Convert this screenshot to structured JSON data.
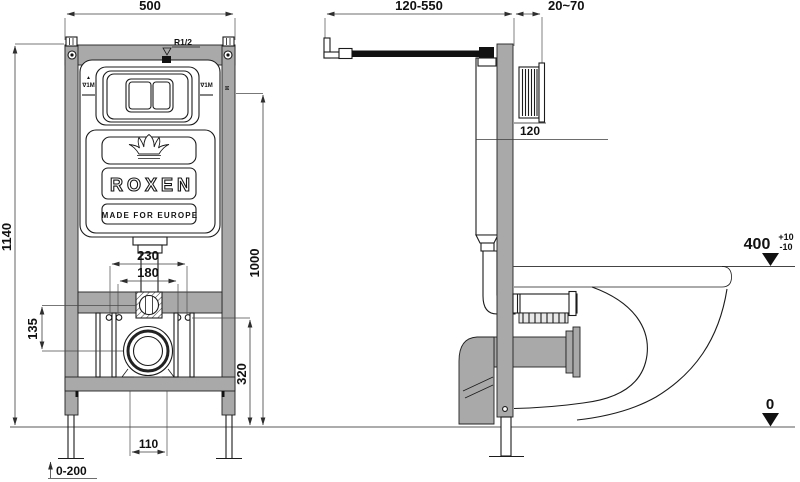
{
  "front_view": {
    "dims": {
      "width": "500",
      "height": "1140",
      "flush_center_height": "1000",
      "top_holes_span": "230",
      "inner_holes_span": "180",
      "outlet_offset": "135",
      "drain_center_height": "320",
      "outlet_width": "110",
      "leg_adjustment": "0-200"
    },
    "labels": {
      "water_inlet": "R1/2",
      "level_mark_arrow": "▲",
      "level_mark_left": "∇1M",
      "level_mark_right": "∇1M",
      "frame_mark": "M"
    },
    "brand": {
      "logo_name": "ROXEN",
      "tagline": "MADE FOR EUROPE"
    }
  },
  "side_view": {
    "dims": {
      "bracket_depth_range": "120-550",
      "wall_distance": "20~70",
      "plate_dim": "120"
    },
    "datums": {
      "rim_level": "400",
      "rim_tol_plus": "+10",
      "rim_tol_minus": "-10",
      "floor_level": "0"
    }
  },
  "colors": {
    "frame_gray": "#a9a9a9",
    "outline": "#1b1b1b",
    "dim_line": "#3c3c3c"
  }
}
